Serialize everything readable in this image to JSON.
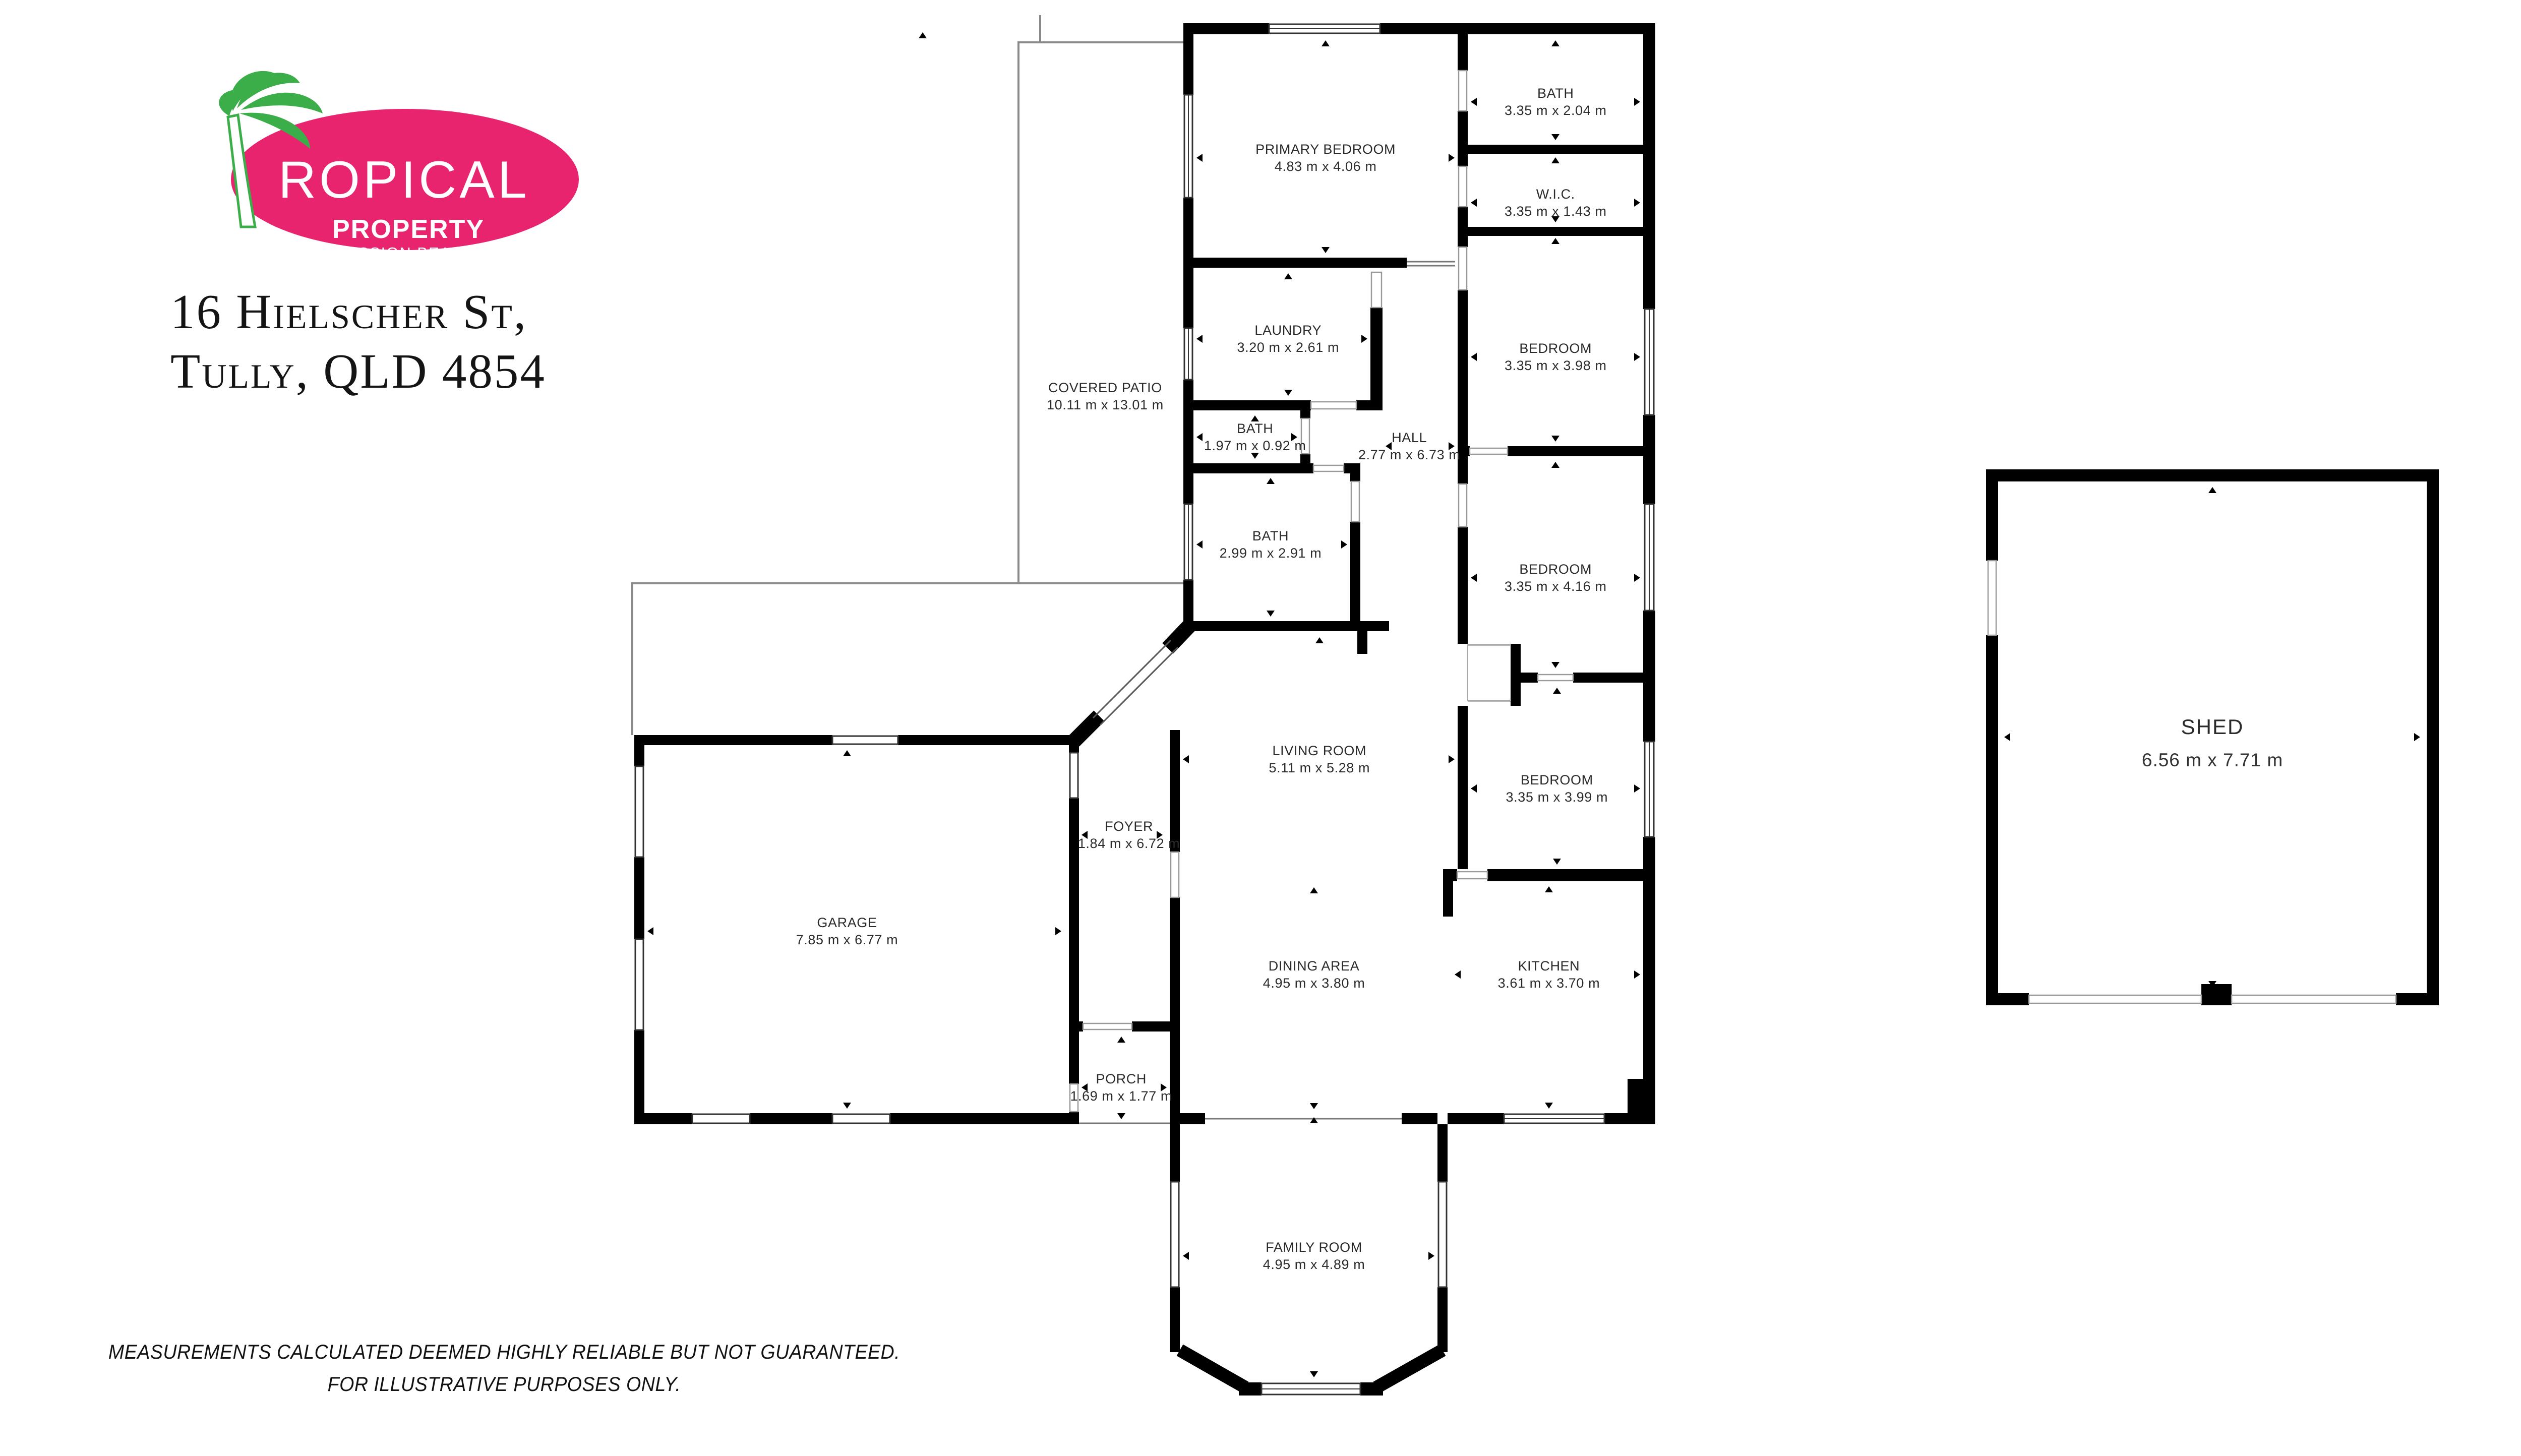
{
  "logo": {
    "brand_top": "ROPICAL",
    "brand_mid": "PROPERTY",
    "brand_bottom": "MISSION BEACH",
    "pink": "#E8246F",
    "green": "#3BAE49"
  },
  "address": {
    "line1": "16 Hielscher St,",
    "line2": "Tully, QLD 4854"
  },
  "disclaimer": {
    "line1": "MEASUREMENTS CALCULATED DEEMED HIGHLY RELIABLE BUT NOT GUARANTEED.",
    "line2": "FOR ILLUSTRATIVE PURPOSES ONLY."
  },
  "rooms": [
    {
      "id": "covered-patio",
      "label": "COVERED PATIO",
      "dims": "10.11 m x 13.01 m"
    },
    {
      "id": "primary-bedroom",
      "label": "PRIMARY BEDROOM",
      "dims": "4.83 m x 4.06 m"
    },
    {
      "id": "bath-ensuite",
      "label": "BATH",
      "dims": "3.35 m x 2.04 m"
    },
    {
      "id": "wic",
      "label": "W.I.C.",
      "dims": "3.35 m x 1.43 m"
    },
    {
      "id": "bedroom-1",
      "label": "BEDROOM",
      "dims": "3.35 m x 3.98 m"
    },
    {
      "id": "laundry",
      "label": "LAUNDRY",
      "dims": "3.20 m x 2.61 m"
    },
    {
      "id": "bath-2",
      "label": "BATH",
      "dims": "1.97 m x 0.92 m"
    },
    {
      "id": "hall",
      "label": "HALL",
      "dims": "2.77 m x 6.73 m"
    },
    {
      "id": "bath-3",
      "label": "BATH",
      "dims": "2.99 m x 2.91 m"
    },
    {
      "id": "bedroom-2",
      "label": "BEDROOM",
      "dims": "3.35 m x 4.16 m"
    },
    {
      "id": "bedroom-3",
      "label": "BEDROOM",
      "dims": "3.35 m x 3.99 m"
    },
    {
      "id": "living-room",
      "label": "LIVING ROOM",
      "dims": "5.11 m x 5.28 m"
    },
    {
      "id": "foyer",
      "label": "FOYER",
      "dims": "1.84 m x 6.72 m"
    },
    {
      "id": "garage",
      "label": "GARAGE",
      "dims": "7.85 m x 6.77 m"
    },
    {
      "id": "dining-area",
      "label": "DINING AREA",
      "dims": "4.95 m x 3.80 m"
    },
    {
      "id": "kitchen",
      "label": "KITCHEN",
      "dims": "3.61 m x 3.70 m"
    },
    {
      "id": "porch",
      "label": "PORCH",
      "dims": "1.69 m x 1.77 m"
    },
    {
      "id": "family-room",
      "label": "FAMILY ROOM",
      "dims": "4.95 m x 4.89 m"
    }
  ],
  "shed": {
    "label": "SHED",
    "dims": "6.56 m x 7.71 m"
  }
}
